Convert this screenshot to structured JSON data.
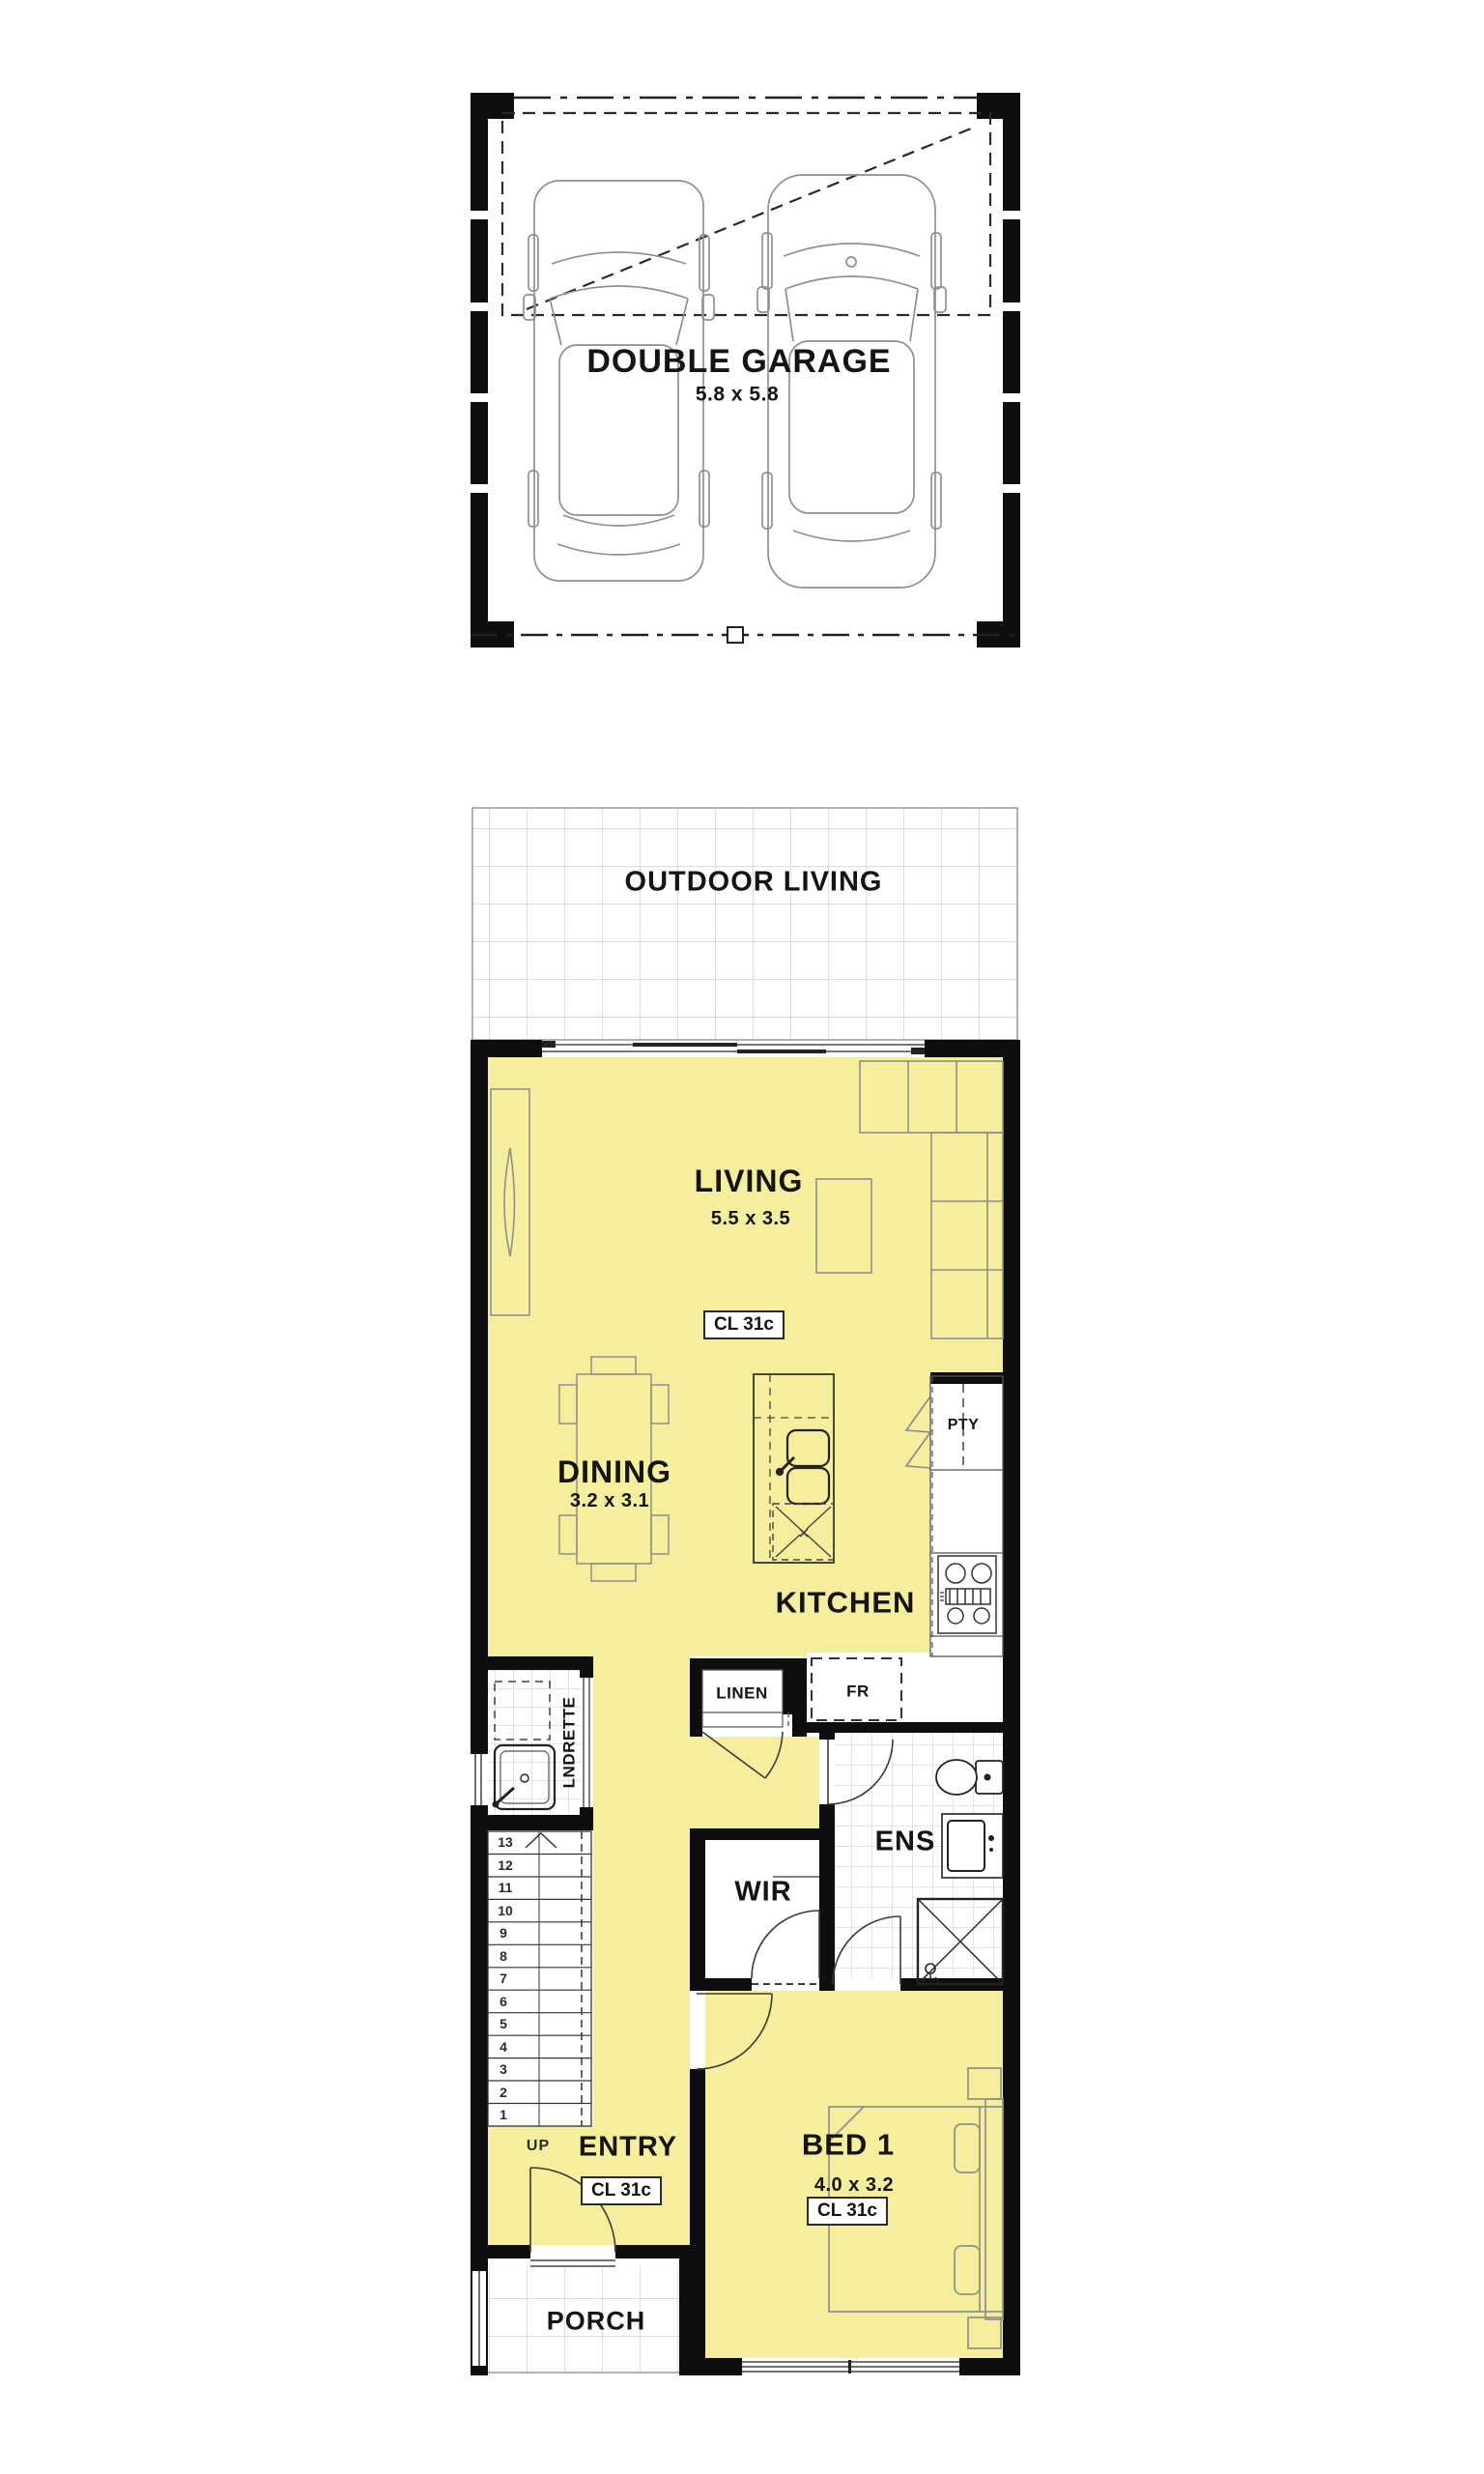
{
  "colors": {
    "floor_fill": "#f4ee9d",
    "wall": "#0e0e0e",
    "furniture_line": "#8f8f8f",
    "fixture_line": "#2e2e2e",
    "tile_line": "#c9c9c9",
    "label_text": "#141414"
  },
  "garage": {
    "label": "DOUBLE GARAGE",
    "dims": "5.8 x 5.8"
  },
  "outdoor": {
    "label": "OUTDOOR LIVING"
  },
  "living": {
    "label": "LIVING",
    "dims": "5.5 x 3.5",
    "ceiling": "CL 31c"
  },
  "dining": {
    "label": "DINING",
    "dims": "3.2 x 3.1"
  },
  "kitchen": {
    "label": "KITCHEN",
    "pantry": "PTY",
    "fridge": "FR",
    "linen": "LINEN"
  },
  "laundry": {
    "label": "LNDRETTE"
  },
  "stairs": {
    "up": "UP",
    "numbers": [
      "1",
      "2",
      "3",
      "4",
      "5",
      "6",
      "7",
      "8",
      "9",
      "10",
      "11",
      "12",
      "13"
    ]
  },
  "entry": {
    "label": "ENTRY",
    "ceiling": "CL 31c"
  },
  "porch": {
    "label": "PORCH"
  },
  "bed1": {
    "label": "BED 1",
    "dims": "4.0 x 3.2",
    "ceiling": "CL 31c"
  },
  "ens": {
    "label": "ENS"
  },
  "wir": {
    "label": "WIR"
  }
}
